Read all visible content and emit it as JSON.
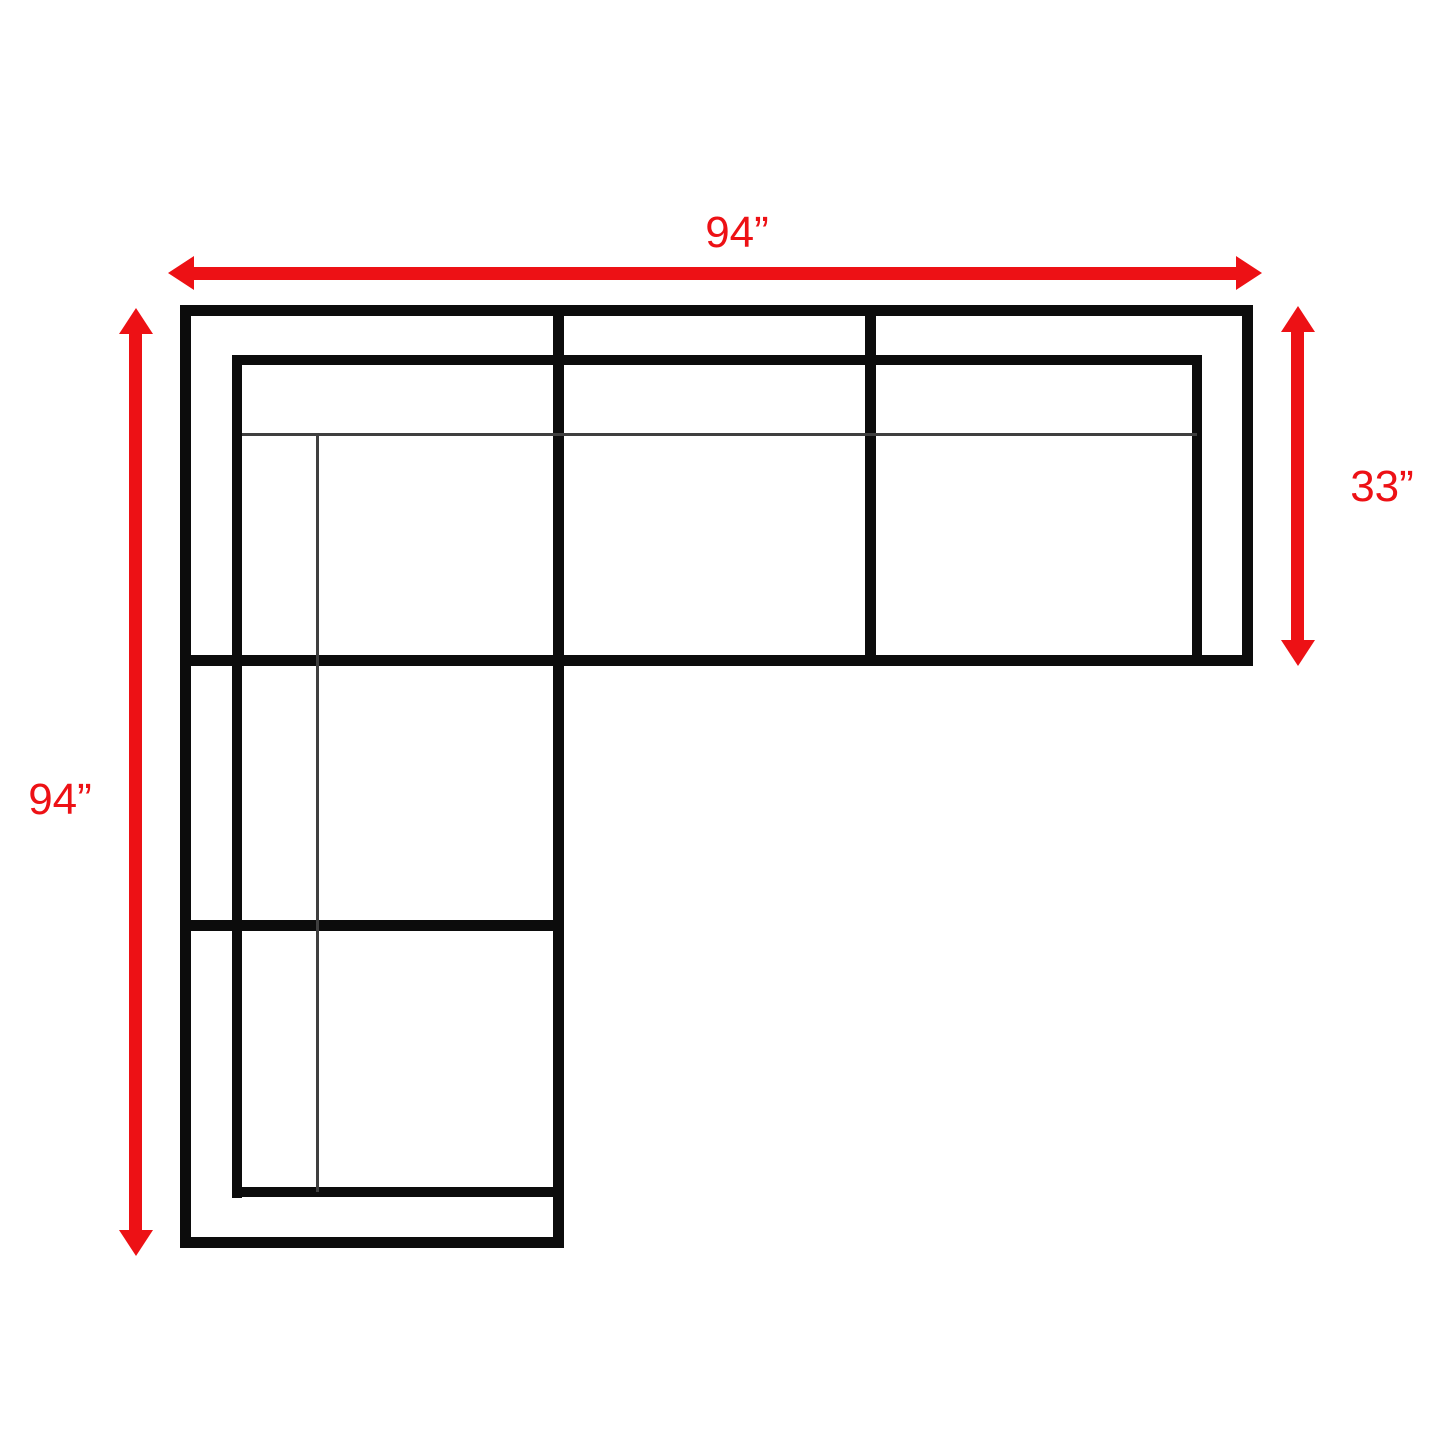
{
  "page": {
    "background": "#ffffff",
    "description": "Top view dimension drawing of an L-shaped sectional sofa"
  },
  "diagram": {
    "type": "sectional-sofa-floorplan",
    "outline_color": "#0c0c0c",
    "cushion_line_color": "#3f3f3f",
    "dimension_color": "#ed1115",
    "dimensions": {
      "top_width": {
        "label": "94”",
        "orientation": "horizontal",
        "edge": "top"
      },
      "left_height": {
        "label": "94”",
        "orientation": "vertical",
        "edge": "left"
      },
      "right_depth": {
        "label": "33”",
        "orientation": "vertical",
        "edge": "right"
      }
    }
  }
}
